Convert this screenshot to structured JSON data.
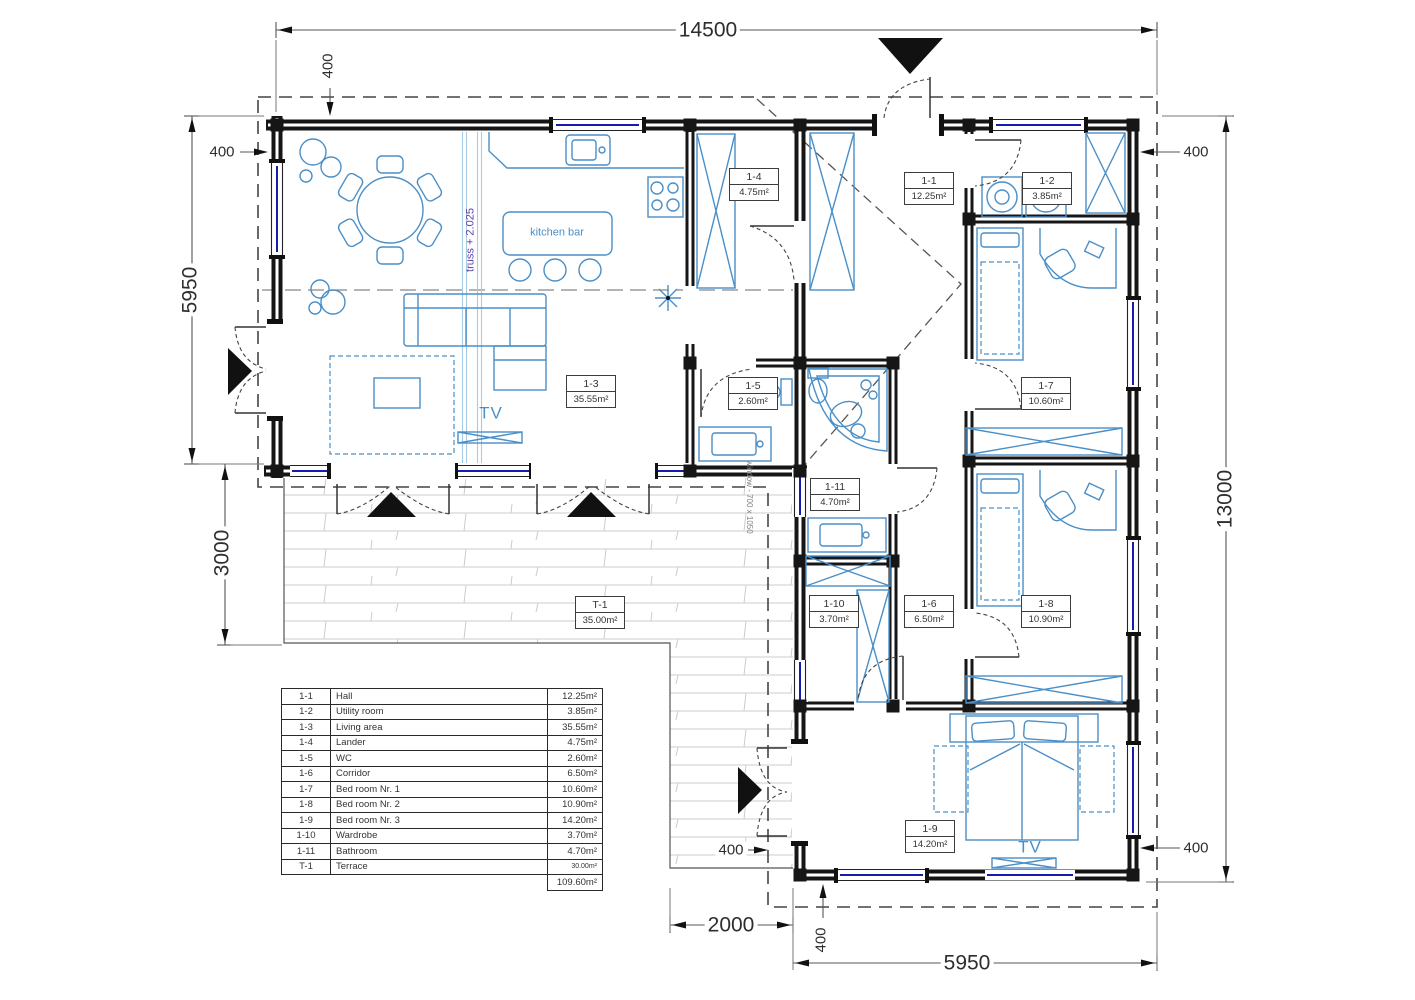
{
  "dimensions": {
    "top_width": "14500",
    "left_height_upper": "5950",
    "left_height_lower": "3000",
    "right_height": "13000",
    "bottom_terrace_width": "2000",
    "bottom_right_width": "5950",
    "offset": "400"
  },
  "plan": {
    "room_labels": [
      {
        "code": "1-4",
        "area": "4.75m²"
      },
      {
        "code": "1-1",
        "area": "12.25m²"
      },
      {
        "code": "1-2",
        "area": "3.85m²"
      },
      {
        "code": "1-3",
        "area": "35.55m²"
      },
      {
        "code": "1-5",
        "area": "2.60m²"
      },
      {
        "code": "1-7",
        "area": "10.60m²"
      },
      {
        "code": "1-11",
        "area": "4.70m²"
      },
      {
        "code": "1-10",
        "area": "3.70m²"
      },
      {
        "code": "1-6",
        "area": "6.50m²"
      },
      {
        "code": "1-8",
        "area": "10.90m²"
      },
      {
        "code": "1-9",
        "area": "14.20m²"
      },
      {
        "code": "T-1",
        "area": "35.00m²"
      }
    ],
    "annotations": {
      "kitchen_bar": "kitchen bar",
      "tv": "TV",
      "truss_note": "truss + 2.025",
      "window_note": "window - 700 x 1050"
    }
  },
  "legend": {
    "rows": [
      {
        "code": "1-1",
        "name": "Hall",
        "area": "12.25m²"
      },
      {
        "code": "1-2",
        "name": "Utility room",
        "area": "3.85m²"
      },
      {
        "code": "1-3",
        "name": "Living area",
        "area": "35.55m²"
      },
      {
        "code": "1-4",
        "name": "Lander",
        "area": "4.75m²"
      },
      {
        "code": "1-5",
        "name": "WC",
        "area": "2.60m²"
      },
      {
        "code": "1-6",
        "name": "Corridor",
        "area": "6.50m²"
      },
      {
        "code": "1-7",
        "name": "Bed room Nr. 1",
        "area": "10.60m²"
      },
      {
        "code": "1-8",
        "name": "Bed room Nr. 2",
        "area": "10.90m²"
      },
      {
        "code": "1-9",
        "name": "Bed room Nr. 3",
        "area": "14.20m²"
      },
      {
        "code": "1-10",
        "name": "Wardrobe",
        "area": "3.70m²"
      },
      {
        "code": "1-11",
        "name": "Bathroom",
        "area": "4.70m²"
      },
      {
        "code": "T-1",
        "name": "Terrace",
        "area": "30.00m²"
      }
    ],
    "total_area": "109.60m²"
  }
}
